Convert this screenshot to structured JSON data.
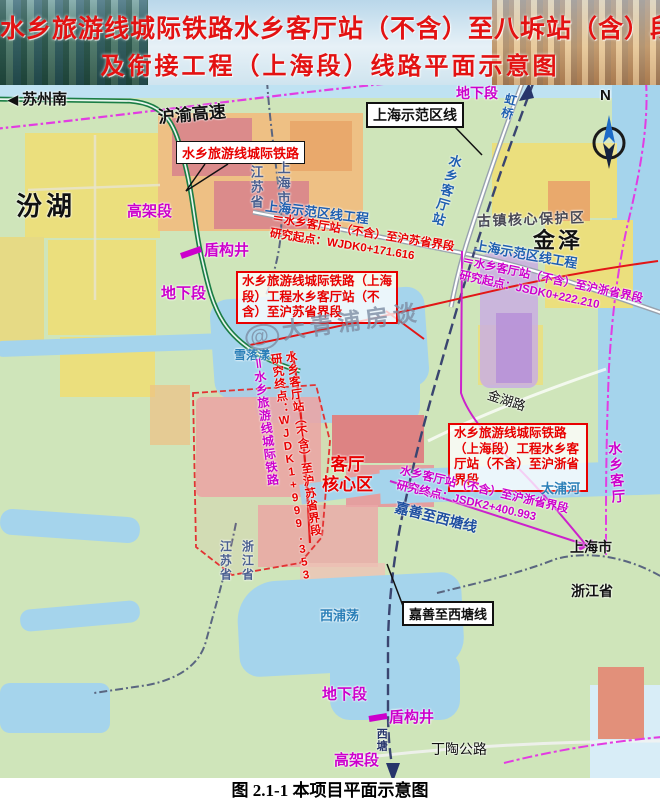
{
  "banner": {
    "title_line1": "水乡旅游线城际铁路水乡客厅站（不含）至八坼站（含）段",
    "title_line2": "及衔接工程（上海段）线路平面示意图"
  },
  "caption": "图 2.1-1 本项目平面示意图",
  "watermark": {
    "at": "@",
    "text": "大青浦房谈"
  },
  "compass": {
    "north_label": "N"
  },
  "icons": {
    "suzhou_arrow": "◀"
  },
  "colors": {
    "title_red": "#e31212",
    "note_red": "#e80000",
    "section_magenta": "#cc00cc",
    "rail_green": "#1b7d45",
    "line_purple": "#3a4570",
    "road_magenta": "#e23ce2",
    "water_blue": "#a5d4ec",
    "label_blue": "#1f5fb0"
  },
  "labels": {
    "directions": {
      "suzhou_south": "苏州南",
      "hongqiao": "虹桥",
      "xitang": "西塘"
    },
    "roads": {
      "huyu_expressway": "沪渝高速",
      "jinhu_road": "金湖路",
      "dingtao_road": "丁陶公路"
    },
    "waters": {
      "fenhu": "汾湖",
      "xueluoyang": "雪落漾",
      "taipu_river": "太浦河",
      "xipudang": "西浦荡"
    },
    "regions": {
      "jiangsu_top": "江苏省",
      "shanghai_top": "上海市",
      "jiangsu_bottom": "江苏省",
      "zhejiang_bottom": "浙江省",
      "shanghai_right": "上海市",
      "zhejiang_right": "浙江省",
      "jinze": "金泽",
      "guzhen_core": "古镇核心保护区",
      "keting_core_line1": "客厅",
      "keting_core_line2": "核心区",
      "shuixiang_keting": "水乡客厅"
    },
    "boxes": {
      "rail_green": "水乡旅游线城际铁路",
      "shifanqu_line": "上海示范区线",
      "jiashan_xitang": "嘉善至西塘线"
    },
    "lines": {
      "shifanqu_project_left": "上海示范区线工程",
      "shifanqu_project_right": "上海示范区线工程",
      "jiashan_xitang_diag": "嘉善至西塘线",
      "rail_label_vertical": "＝水乡旅游线城际铁路",
      "keting_station": "水乡客厅站"
    },
    "sections": {
      "elevated_top": "高架段",
      "shield_top": "盾构井",
      "underground_left": "地下段",
      "underground_top": "地下段",
      "underground_bottom": "地下段",
      "shield_bottom": "盾构井",
      "elevated_bottom": "高架段"
    },
    "notes": {
      "wjdk_start_line1": "＝水乡客厅站（不含）至沪苏省界段",
      "wjdk_start_line2": "研究起点：WJDK0+171.616",
      "wjdk_end_line1": "水乡客厅站（不含）至沪苏省界段",
      "wjdk_end_line2": "研究终点：WJDK1+999.353",
      "jsdk_start_line1": "＝水乡客厅站（不含）至沪浙省界段",
      "jsdk_start_line2": "研究起点：JSDK0+222.210",
      "jsdk_end_line1": "水乡客厅站（不含）至沪浙省界段",
      "jsdk_end_line2": "研究终点：JSDK2+400.993",
      "project_box_left": "水乡旅游线城际铁路（上海段）工程水乡客厅站（不含）至沪苏省界段",
      "project_box_right": "水乡旅游线城际铁路（上海段）工程水乡客厅站（不含）至沪浙省界段"
    }
  }
}
